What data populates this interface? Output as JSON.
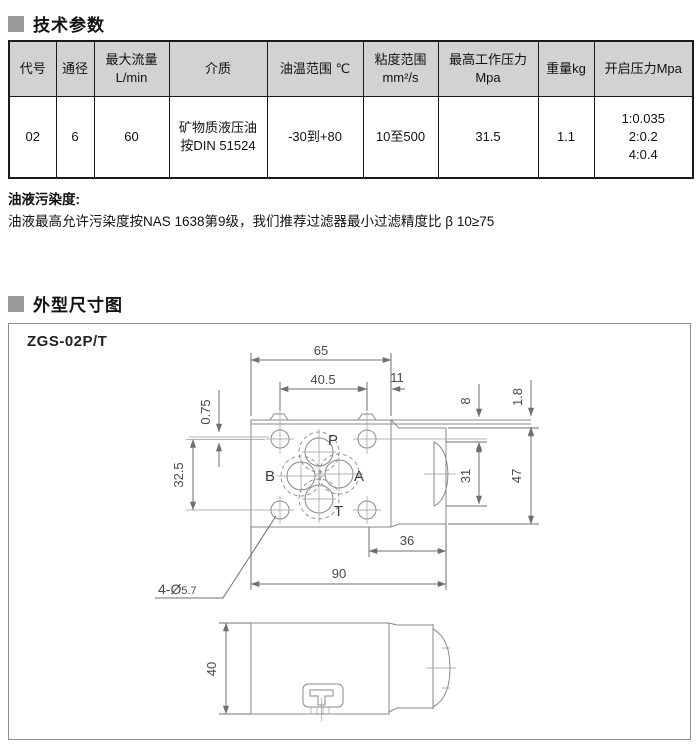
{
  "sections": {
    "tech_title": "技术参数",
    "dims_title": "外型尺寸图"
  },
  "colors": {
    "header_bg": "#d2d2d2",
    "title_square": "#9a9a9a",
    "drawing_line": "#8a8a8a"
  },
  "table": {
    "headers": {
      "code": "代号",
      "bore": "通径",
      "flow_l1": "最大流量",
      "flow_l2": "L/min",
      "medium": "介质",
      "oil_temp": "油温范围 ℃",
      "visc_l1": "粘度范围",
      "visc_l2": "mm²/s",
      "max_pressure_l1": "最高工作压力",
      "max_pressure_l2": "Mpa",
      "weight": "重量kg",
      "opening_pressure": "开启压力Mpa"
    },
    "row": {
      "code": "02",
      "bore": "6",
      "flow": "60",
      "medium_l1": "矿物质液压油",
      "medium_l2": "按DIN 51524",
      "oil_temp": "-30到+80",
      "visc": "10至500",
      "max_pressure": "31.5",
      "weight": "1.1",
      "opening": [
        "1:0.035",
        "2:0.2",
        "4:0.4"
      ]
    }
  },
  "note": {
    "title": "油液污染度:",
    "body": "油液最高允许污染度按NAS 1638第9级，我们推荐过滤器最小过滤精度比 β 10≥75"
  },
  "drawing": {
    "model": "ZGS-02P/T",
    "ports": {
      "p": "P",
      "a": "A",
      "b": "B",
      "t": "T"
    },
    "dims": {
      "d65": "65",
      "d405": "40.5",
      "d11": "11",
      "d075": "0.75",
      "d325": "32.5",
      "d8": "8",
      "d18": "1.8",
      "d31": "31",
      "d47": "47",
      "d36": "36",
      "d90": "90",
      "d40": "40",
      "holes_prefix": "4-Ø",
      "holes_size": "5.7"
    }
  }
}
